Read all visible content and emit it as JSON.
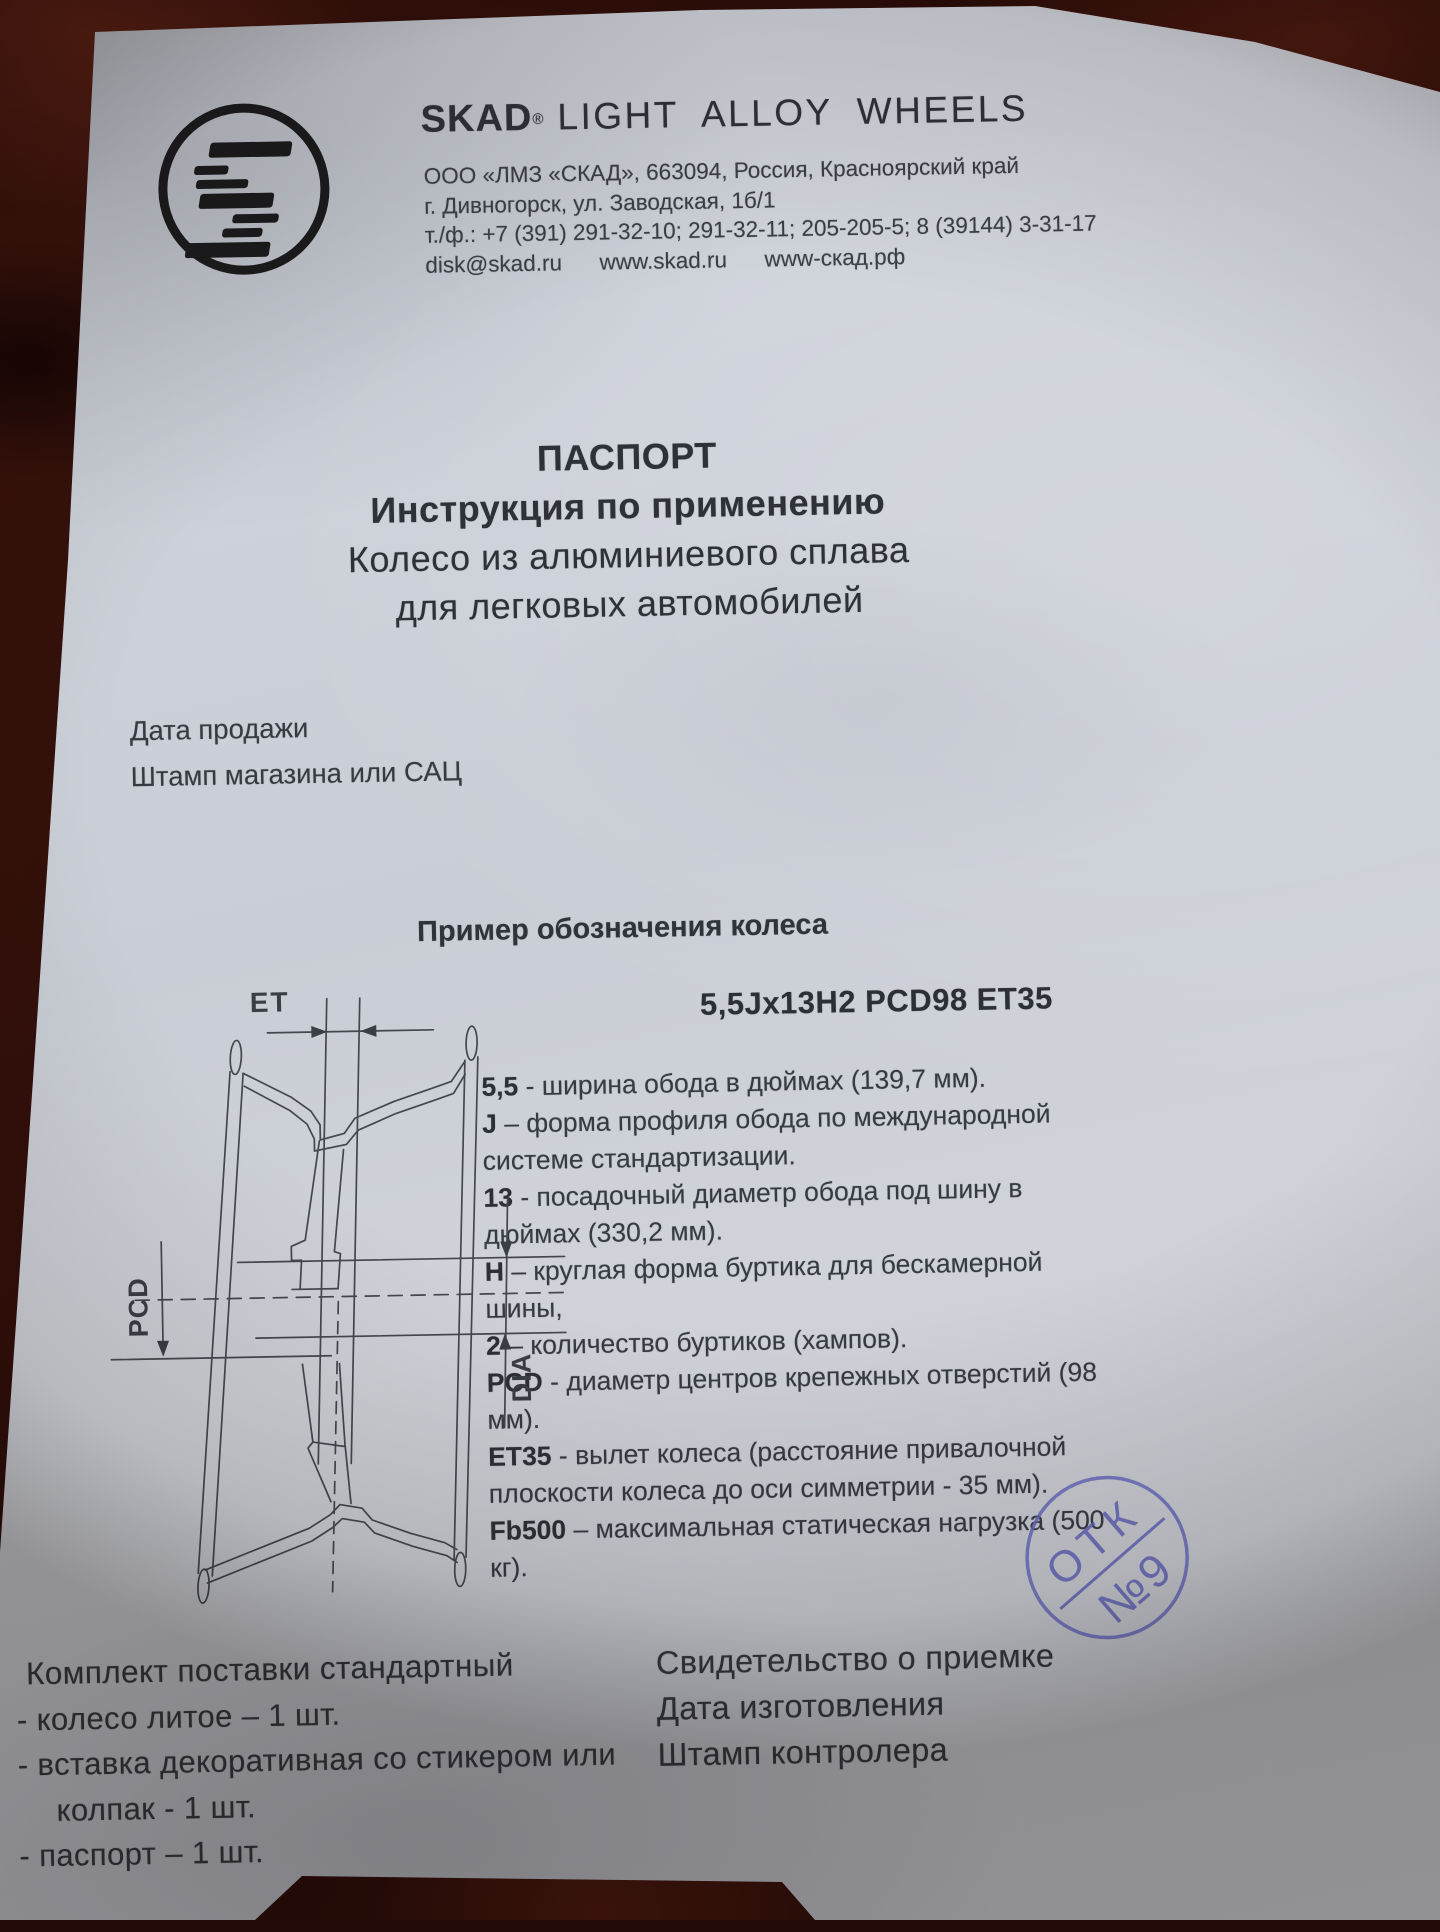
{
  "header": {
    "brand": "SKAD",
    "brand_reg": "®",
    "brand_tagline": "LIGHT ALLOY WHEELS",
    "address_lines": [
      "ООО «ЛМЗ «СКАД», 663094, Россия, Красноярский край",
      "г. Дивногорск, ул. Заводская, 1б/1",
      "т./ф.: +7 (391) 291-32-10; 291-32-11; 205-205-5; 8 (39144) 3-31-17",
      "disk@skad.ru      www.skad.ru      www-скад.рф"
    ]
  },
  "title": {
    "lines": [
      "ПАСПОРТ",
      "Инструкция по применению",
      "Колесо из алюминиевого сплава",
      "для легковых автомобилей"
    ]
  },
  "sale": {
    "date_label": "Дата продажи",
    "stamp_label": "Штамп магазина или САЦ"
  },
  "example": {
    "heading": "Пример обозначения колеса",
    "designation": "5,5Jx13H2 PCD98 ET35",
    "spec_lines": [
      {
        "term": "5,5",
        "text": " - ширина обода в дюймах (139,7 мм)."
      },
      {
        "term": "J",
        "text": " – форма профиля обода по международной системе стандартизации."
      },
      {
        "term": "13",
        "text": " - посадочный диаметр обода под шину в дюймах (330,2 мм)."
      },
      {
        "term": "H",
        "text": " – круглая форма буртика для бескамерной шины,"
      },
      {
        "term": "2",
        "text": " – количество буртиков (хампов)."
      },
      {
        "term": "PCD",
        "text": " - диаметр центров крепежных отверстий (98 мм)."
      },
      {
        "term": "ET35",
        "text": " - вылет колеса (расстояние привалочной плоскости колеса до оси симметрии - 35 мм)."
      },
      {
        "term": "Fb500",
        "text": " – максимальная статическая нагрузка (500 кг)."
      }
    ]
  },
  "diagram": {
    "labels": {
      "et": "ET",
      "pcd": "PCD",
      "dia": "DIA"
    }
  },
  "stamp": {
    "line1": "ОТК",
    "line2": "№9",
    "color": "#5d60b8"
  },
  "package": {
    "heading": "Комплект поставки стандартный",
    "items": [
      {
        "text": "- колесо литое – 1 шт."
      },
      {
        "text": "- вставка декоративная со стикером или"
      },
      {
        "text": "колпак - 1 шт.",
        "indent": true
      },
      {
        "text": "- паспорт – 1 шт."
      }
    ]
  },
  "acceptance": {
    "lines": [
      "Свидетельство о приемке",
      "Дата изготовления",
      "Штамп контролера"
    ]
  }
}
